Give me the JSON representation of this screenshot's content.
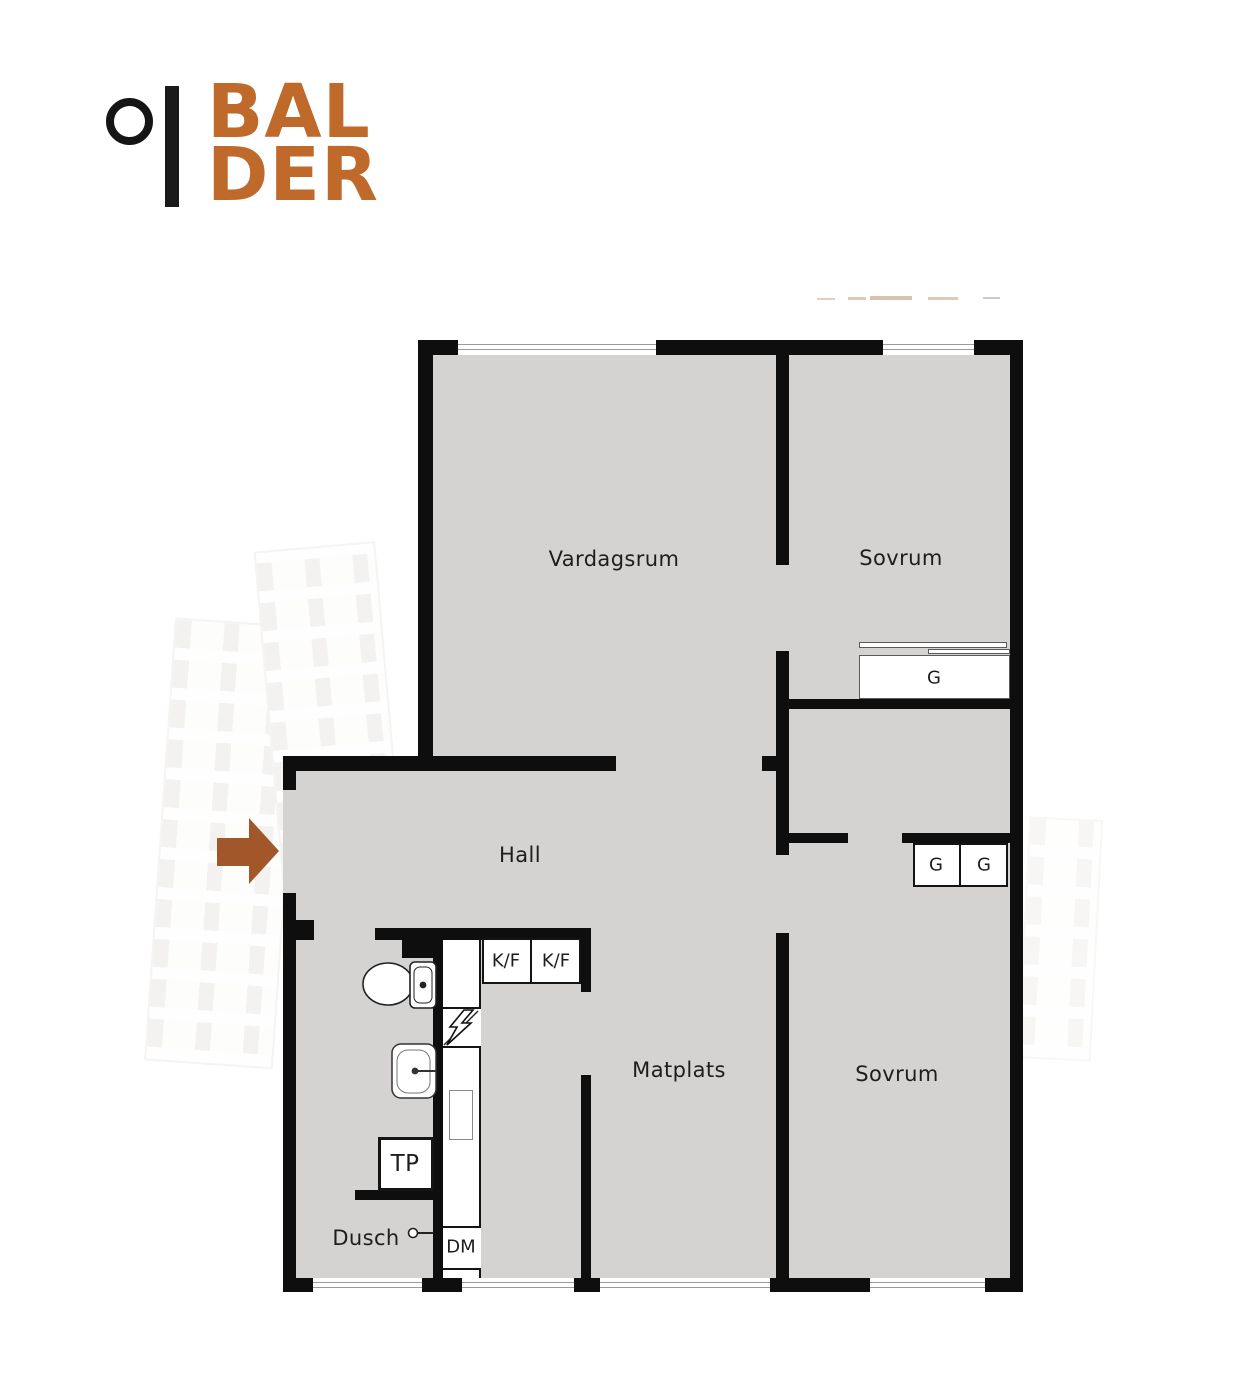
{
  "brand": {
    "line1": "BAL",
    "line2": "DER"
  },
  "colors": {
    "brand_orange": "#bf692b",
    "entrance_arrow_brown": "#a2572b",
    "wall_black": "#0e0e0e",
    "floor_gray": "#d4d3d2"
  },
  "floorplan": {
    "rooms": [
      {
        "name": "Vardagsrum"
      },
      {
        "name": "Sovrum"
      },
      {
        "name": "Hall"
      },
      {
        "name": "Matplats"
      },
      {
        "name": "Sovrum"
      },
      {
        "name": "Dusch"
      }
    ],
    "fixtures": {
      "wardrobe_top": "G",
      "wardrobe_left": "G",
      "wardrobe_right": "G",
      "fridge_freezer_1": "K/F",
      "fridge_freezer_2": "K/F",
      "laundry_unit": "TP",
      "dishwasher": "DM"
    }
  }
}
